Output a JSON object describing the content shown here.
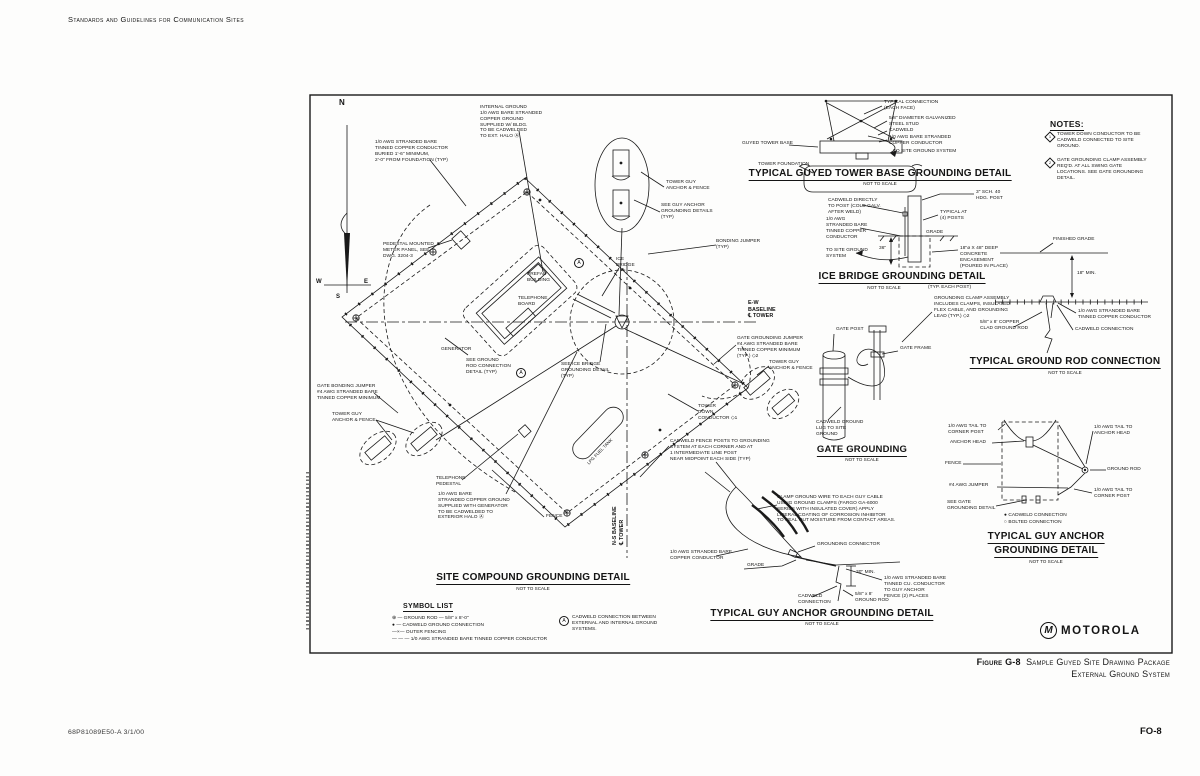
{
  "page": {
    "header": "Standards and Guidelines for Communication Sites",
    "footer_left": "68P81089E50-A    3/1/00",
    "footer_right": "FO-8",
    "caption_label": "Figure G-8",
    "caption_line1": "Sample Guyed Site Drawing Package",
    "caption_line2": "External Ground System"
  },
  "compass": {
    "n": "N",
    "e": "E",
    "s": "S",
    "w": "W"
  },
  "notes": {
    "title": "NOTES:",
    "items": [
      {
        "num": "1",
        "text": "TOWER DOWN CONDUCTOR TO BE\nCADWELD CONNECTED TO SITE\nGROUND."
      },
      {
        "num": "2",
        "text": "GATE GROUNDING CLAMP ASSEMBLY\nREQ'D. AT ALL SWING GATE\nLOCATIONS. SEE GATE GROUNDING\nDETAIL."
      }
    ]
  },
  "site_plan": {
    "title": "SITE COMPOUND GROUNDING DETAIL",
    "scale": "NOT TO SCALE",
    "marker_a": "A",
    "labels": {
      "internal_ground": "INTERNAL GROUND\n1/0 AWG BARE STRANDED\nCOPPER GROUND\nSUPPLIED W/ BLDG.\nTO BE CADWELDED\nTO EXT. HALO  Ⓐ",
      "buried_conductor": "1/0 AWG STRANDED BARE\nTINNED COPPER CONDUCTOR\nBURIED 1'-6\" MINIMUM,\n2'-0\" FROM FOUNDATION (TYP)",
      "pedestal_meter": "PEDESTAL MOUNTED\nMETER PANEL, SEE\nDWG. 3204-3",
      "prefab_building": "PREFAB\nBUILDING",
      "telephone_board": "TELEPHONE\nBOARD",
      "generator": "GENERATOR",
      "ice_bridge": "ICE\nBRIDGE",
      "see_ice_bridge": "SEE ICE BRIDGE\nGROUNDING DETAIL\n(TYP)",
      "see_ground_rod": "SEE GROUND\nROD CONNECTION\nDETAIL (TYP)",
      "ew_baseline": "E-W\nBASELINE\n℄ TOWER",
      "ns_baseline": "N-S BASELINE\n℄ TOWER",
      "bonding_jumper": "BONDING JUMPER\n(TYP)",
      "tower_guy_anchor": "TOWER GUY\nANCHOR & FENCE",
      "see_guy_anchor": "SEE GUY ANCHOR\nGROUNDING DETAILS\n(TYP)",
      "gate_grounding_jumper": "GATE GROUNDING JUMPER\n#4 AWG STRANDED BARE\nTINNED COPPER MINIMUM\n(TYP.)  ◇2",
      "tower_down_conductor": "TOWER\nDOWN\nCONDUCTOR  ◇1",
      "gate_bonding_jumper": "GATE BONDING JUMPER\n#4 AWG STRANDED BARE\nTINNED COPPER MINIMUM",
      "telephone_pedestal": "TELEPHONE\nPEDESTAL",
      "generator_ground": "1/0 AWG BARE\nSTRANDED COPPER GROUND\nSUPPLIED WITH GENERATOR\nTO BE CADWELDED TO\nEXTERIOR HALO  Ⓐ",
      "fence": "FENCE",
      "cadweld_fence_posts": "CADWELD FENCE POSTS TO GROUNDING\nSYSTEM AT EACH CORNER AND AT\n1 INTERMEDIATE LINE POST\nNEAR MIDPOINT EACH SIDE (TYP)",
      "lpg_tank": "LPG FUEL TANK"
    }
  },
  "tower_base": {
    "title": "TYPICAL GUYED TOWER BASE GROUNDING DETAIL",
    "scale": "NOT TO SCALE",
    "labels": {
      "typical_connection": "TYPICAL CONNECTION\n(EACH FACE)",
      "stud": "5/8\" DIAMETER GALVANIZED\nSTEEL STUD",
      "cadweld": "CADWELD",
      "conductor": "1/0 AWG BARE STRANDED\nCOPPER CONDUCTOR",
      "to_site": "TO SITE GROUND SYSTEM",
      "base": "GUYED TOWER BASE",
      "foundation": "TOWER FOUNDATION"
    }
  },
  "ice_bridge": {
    "title": "ICE BRIDGE GROUNDING DETAIL",
    "scale": "NOT TO SCALE",
    "typ_each_post": "(TYP. EACH POST)",
    "labels": {
      "post": "3\" SCH. 40\nHDG. POST",
      "cadweld": "CADWELD DIRECTLY\nTO POST (COLD GALV.\nAFTER WELD)",
      "conductor": "1/0 AWG\nSTRANDED BARE\nTINNED COPPER\nCONDUCTOR",
      "typical": "TYPICAL AT\n(4) POSTS",
      "grade": "GRADE",
      "depth": "36\"",
      "encasement": "18\"ø X 48\" DEEP\nCONCRETE\nENCASEMENT\n(POURED IN PLACE)",
      "to_site": "TO SITE GROUND\nSYSTEM"
    }
  },
  "ground_rod": {
    "title": "TYPICAL GROUND ROD CONNECTION",
    "scale": "NOT TO SCALE",
    "labels": {
      "finished_grade": "FINISHED GRADE",
      "min_depth": "18\" MIN.",
      "conductor": "1/0 AWG STRANDED BARE\nTINNED COPPER CONDUCTOR",
      "cadweld": "CADWELD CONNECTION",
      "rod": "5/8\" x 8' COPPER\nCLAD GROUND ROD"
    }
  },
  "gate": {
    "title": "GATE GROUNDING",
    "scale": "NOT TO SCALE",
    "labels": {
      "post": "GATE POST",
      "frame": "GATE FRAME",
      "lug": "CADWELD GROUND\nLUG TO SITE\nGROUND",
      "clamp_assembly": "GROUNDING CLAMP ASSEMBLY\nINCLUDES CLAMPS, INSULATED\nFLEX CABLE, AND GROUNDING\nLEAD (TYP.)  ◇2"
    }
  },
  "guy_anchor_right": {
    "title_line1": "TYPICAL GUY ANCHOR",
    "title_line2": "GROUNDING DETAIL",
    "scale": "NOT TO SCALE",
    "labels": {
      "tail_corner_top": "1/0 AWG TAIL TO\nCORNER POST",
      "anchor_head": "ANCHOR HEAD",
      "tail_anchor_head": "1/0 AWG TAIL TO\nANCHOR HEAD",
      "fence": "FENCE",
      "ground_rod": "GROUND ROD",
      "jumper": "#4 AWG JUMPER",
      "tail_corner_bottom": "1/0 AWG TAIL TO\nCORNER POST",
      "see_gate": "SEE GATE\nGROUNDING DETAIL",
      "legend_cadweld": "●  CADWELD CONNECTION",
      "legend_bolted": "○  BOLTED CONNECTION"
    }
  },
  "guy_anchor_bottom": {
    "title": "TYPICAL GUY ANCHOR GROUNDING DETAIL",
    "scale": "NOT TO SCALE",
    "labels": {
      "clamp_note": "CLAMP GROUND WIRE TO EACH GUY CABLE\nUSING GROUND CLAMPS (FARGO GA-6000\nSERIES WITH INSULATED COVER) APPLY\nLIBERAL COATING OF CORROSION INHIBITOR\nTO SEAL OUT MOISTURE FROM CONTACT AREAS.",
      "connector": "GROUNDING CONNECTOR",
      "conductor": "1/0 AWG STRANDED BARE\nCOPPER CONDUCTOR",
      "grade": "GRADE",
      "min_burial": "30\" MIN.",
      "tinned": "1/0 AWG STRANDED BARE\nTINNED CU. CONDUCTOR\nTO GUY ANCHOR\nFENCE (2) PLACES",
      "cadweld": "CADWELD\nCONNECTION",
      "rod": "5/8\" x 8'\nGROUND ROD"
    }
  },
  "symbol_list": {
    "title": "SYMBOL LIST",
    "items": [
      "⊕ —   GROUND ROD — 5/8\" x 8'-0\"",
      "● —   CADWELD GROUND CONNECTION",
      "—×—   OUTER FENCING",
      "— — —   1/0 AWG STRANDED BARE TINNED COPPER CONDUCTOR"
    ],
    "note_a_marker": "A",
    "note_a": "CADWELD CONNECTION BETWEEN\nEXTERNAL AND INTERNAL GROUND\nSYSTEMS."
  },
  "logo": {
    "brand": "MOTOROLA",
    "monogram": "M"
  }
}
